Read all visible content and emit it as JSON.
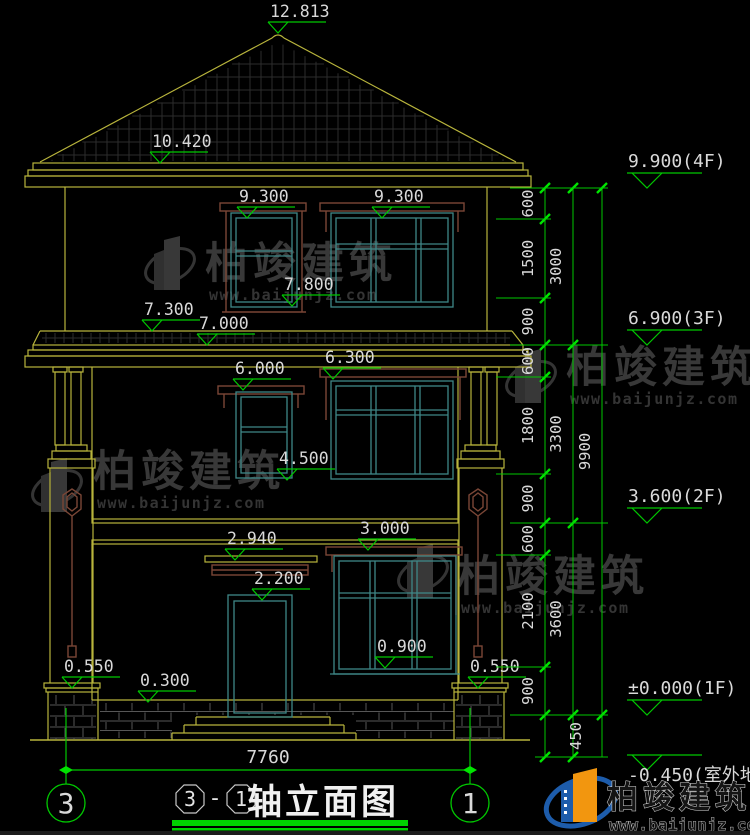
{
  "colors": {
    "background": "#000000",
    "line_yellow": "#b8b43c",
    "line_teal": "#3f8787",
    "line_brown": "#7a4636",
    "dim_green": "#00c800",
    "tick_green": "#00e400",
    "text_white": "#d9d9d9",
    "title_underline": "#00d400",
    "watermark_gray": "#383838",
    "hatch_gray": "#2c2c2c",
    "masonry_gray": "#565656",
    "logo_blue": "#1d5cab",
    "logo_orange": "#f2960f"
  },
  "elevation_markers": [
    {
      "label": "12.813",
      "tx": 278,
      "ty": 33
    },
    {
      "label": "10.420",
      "tx": 160,
      "ty": 163
    },
    {
      "label": "9.300",
      "tx": 247,
      "ty": 218
    },
    {
      "label": "9.300",
      "tx": 382,
      "ty": 218
    },
    {
      "label": "7.800",
      "tx": 292,
      "ty": 306
    },
    {
      "label": "7.300",
      "tx": 152,
      "ty": 331
    },
    {
      "label": "7.000",
      "tx": 207,
      "ty": 345
    },
    {
      "label": "6.300",
      "tx": 333,
      "ty": 379
    },
    {
      "label": "6.000",
      "tx": 243,
      "ty": 390
    },
    {
      "label": "4.500",
      "tx": 287,
      "ty": 480
    },
    {
      "label": "2.940",
      "tx": 235,
      "ty": 560
    },
    {
      "label": "3.000",
      "tx": 368,
      "ty": 550
    },
    {
      "label": "2.200",
      "tx": 262,
      "ty": 600
    },
    {
      "label": "0.900",
      "tx": 385,
      "ty": 668
    },
    {
      "label": "0.550",
      "tx": 72,
      "ty": 688
    },
    {
      "label": "0.300",
      "tx": 148,
      "ty": 702
    },
    {
      "label": "0.550",
      "tx": 478,
      "ty": 688
    }
  ],
  "floor_markers": [
    {
      "label": "9.900(4F)",
      "y": 188
    },
    {
      "label": "6.900(3F)",
      "y": 345
    },
    {
      "label": "3.600(2F)",
      "y": 523
    },
    {
      "label": "±0.000(1F)",
      "y": 715
    },
    {
      "label": "-0.450(室外地面)",
      "y": 770,
      "below": true
    }
  ],
  "dim_chains": {
    "inner": {
      "x": 545,
      "label_x": 533,
      "ticks": [
        188,
        219,
        298,
        345,
        377,
        474,
        523,
        555,
        667,
        715,
        757
      ],
      "labels": [
        "600",
        "1500",
        "900",
        "600",
        "1800",
        "900",
        "600",
        "2100",
        "900",
        ""
      ]
    },
    "middle": {
      "x": 573,
      "label_x": 561,
      "ticks": [
        188,
        345,
        523,
        715,
        757
      ],
      "labels": [
        "3000",
        "3300",
        "3600",
        ""
      ]
    },
    "outer": {
      "x": 602,
      "label_x": 590,
      "ticks": [
        188,
        715
      ],
      "labels": [
        "9900"
      ]
    },
    "extra_label": {
      "text": "450",
      "x": 581,
      "y": 736
    }
  },
  "bottom_dim": {
    "label": "7760"
  },
  "axis_bubbles": {
    "left": "3",
    "right": "1"
  },
  "title_block": {
    "ref_start": "3",
    "dash": "-",
    "ref_end": "1",
    "title": "轴立面图"
  },
  "watermark": {
    "brand": "柏竣建筑",
    "site": "www.baijunjz.com",
    "positions": [
      {
        "tx": 205,
        "ty": 278,
        "gx": 170,
        "gy": 266
      },
      {
        "tx": 93,
        "ty": 486,
        "gx": 57,
        "gy": 488
      },
      {
        "tx": 566,
        "ty": 382,
        "gx": 531,
        "gy": 379
      },
      {
        "tx": 457,
        "ty": 591,
        "gx": 423,
        "gy": 574
      }
    ]
  },
  "logo": {
    "brand": "柏竣建筑",
    "site": "www.baijunjz.com"
  }
}
